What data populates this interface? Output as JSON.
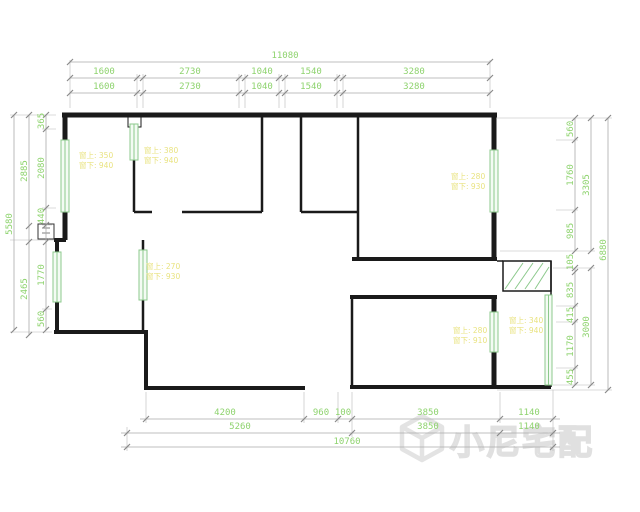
{
  "watermark": {
    "brand": "小尼宅配"
  },
  "colors": {
    "wall": "#1a1a1a",
    "window_green": "#8cc98c",
    "dim_text_green": "#8ed36e",
    "dim_line_gray": "#ababab",
    "label_yellow": "#e9e381",
    "watermark_gray": "#e3e3e3"
  },
  "dims": {
    "top": {
      "total": "11080",
      "row1": [
        "1600",
        "2730",
        "1040",
        "1540",
        "3280"
      ],
      "row2": [
        "1600",
        "2730",
        "1040",
        "1540",
        "3280"
      ]
    },
    "bottom": {
      "row1": [
        "4200",
        "960",
        "100",
        "3850",
        "1140"
      ],
      "row2": [
        "5260",
        "3850",
        "1140"
      ],
      "total": "10760"
    },
    "left": {
      "total": "5580",
      "mid": [
        "2885",
        "2465"
      ],
      "inner": [
        "365",
        "2080",
        "440",
        "1770",
        "560"
      ]
    },
    "right": {
      "total": "6880",
      "mid": [
        "3305",
        "3000"
      ],
      "inner": [
        "560",
        "1760",
        "985",
        "105",
        "835",
        "415",
        "1170",
        "455"
      ]
    }
  },
  "labels": [
    {
      "l1": "窗上: 350",
      "l2": "窗下: 940"
    },
    {
      "l1": "窗上: 380",
      "l2": "窗下: 940"
    },
    {
      "l1": "窗上: 280",
      "l2": "窗下: 930"
    },
    {
      "l1": "窗上: 270",
      "l2": "窗下: 930"
    },
    {
      "l1": "窗上: 280",
      "l2": "窗下: 910"
    },
    {
      "l1": "窗上: 340",
      "l2": "窗下: 940"
    }
  ]
}
